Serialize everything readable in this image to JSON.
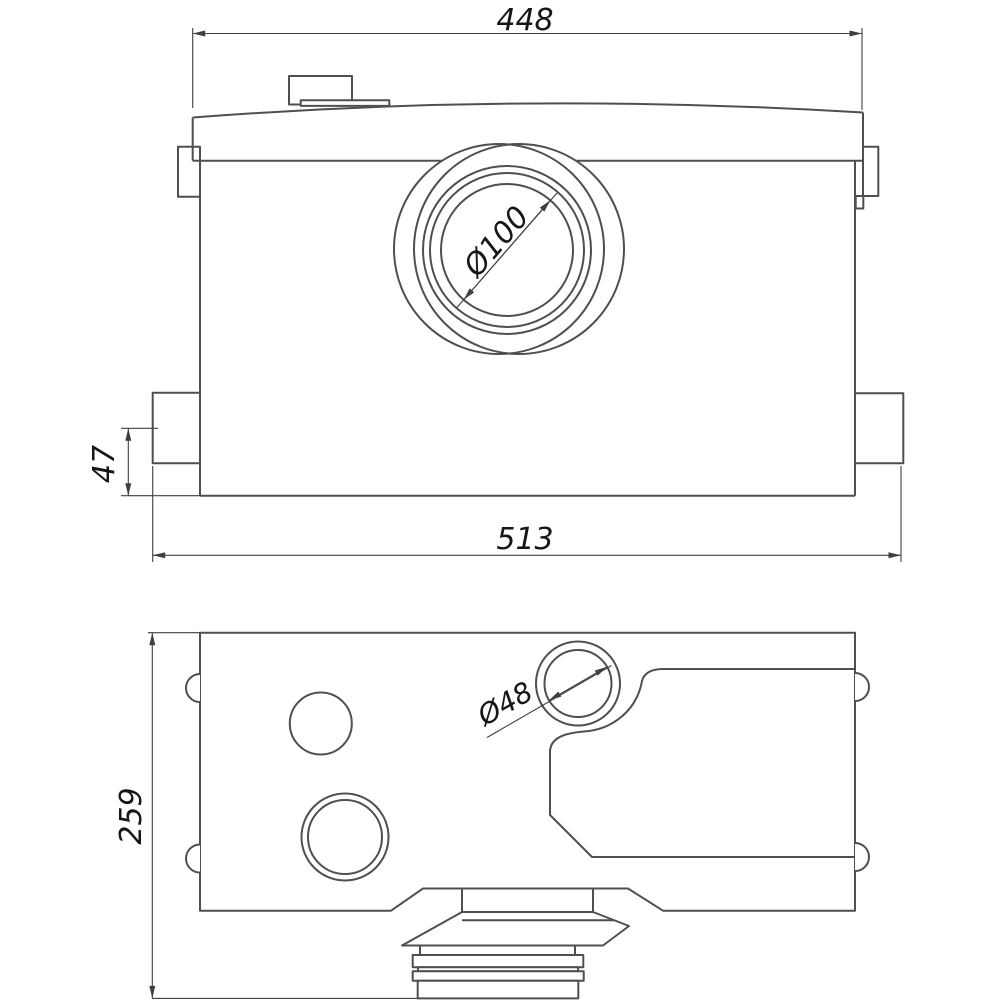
{
  "drawing": {
    "title": "Macerator pump dimensional drawing, two orthographic views",
    "colors": {
      "background": "#ffffff",
      "outline": "#4f4f4f",
      "dimension_line": "#3f3f3f",
      "dimension_text": "#161616"
    },
    "views": {
      "front_view": "front elevation with outlet opening",
      "plan_view": "plan view with inlets and discharge spigot"
    },
    "dims": {
      "top_width": "448",
      "overall_width": "513",
      "inlet_center_offset": "47",
      "outlet_diameter": "Ø100",
      "depth": "259",
      "top_inlet_diameter": "Ø48"
    }
  }
}
